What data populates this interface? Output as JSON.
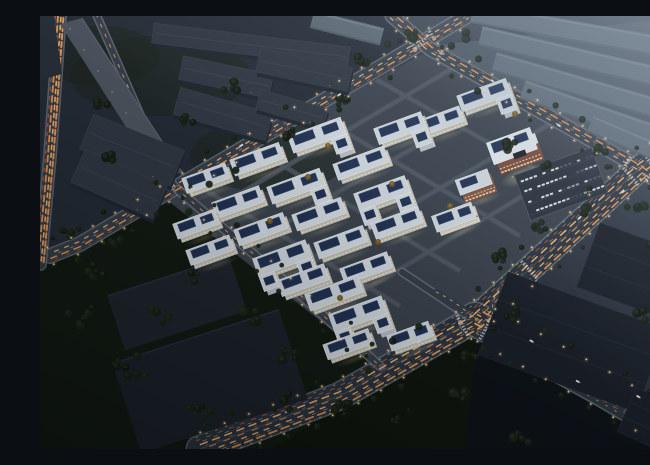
{
  "meta": {
    "description": "Aerial dusk rendering of an illuminated industrial park campus with grid streets, light-trail roads, solar rooftops and surrounding dark warehouses"
  },
  "palette": {
    "bg_top": "#3e4955",
    "bg_mid": "#2a323d",
    "bg_low": "#151b23",
    "hazy_ground": "#46515d",
    "tl_ground": "#242b35",
    "green_dark": "#121a13",
    "wedge_green": "#10160f",
    "below_se": "#0e1319",
    "right_tri": "#2a323c",
    "campus_ground": "#39414b",
    "street": "#49525c",
    "curb": "#6d7681",
    "road": "#343d48",
    "road_dark": "#2b333e",
    "median": "#515d69",
    "facade": "#b4bbc1",
    "roof": "#ccd4da",
    "roof_edge": "#e4e9ec",
    "solar": "#223150",
    "solar_line": "#3a5185",
    "warm1": "#ecd6a0",
    "warm2": "#d0bd8e",
    "hq_red": "#77493b",
    "hq_red_dark": "#5d382e",
    "hq_white": "#dde3e7",
    "tl_roof": "#2e3641",
    "tl_side": "#1f2630",
    "tl_ridge": "#3a4350",
    "hazy_fill": "#5d6975",
    "hazy_ridge": "#717d89",
    "bl_fill": "#1f252e",
    "bl_fill2": "#1c222b",
    "dr_fill": "#191f28",
    "slab_fill": "#49525c",
    "tree_a": "#121a11",
    "tree_b": "#161f15",
    "tree_c": "#1a241a",
    "tree_warm": "#6e5423",
    "tree_warm_core": "#8a6c30",
    "light_dot": "#ffd9a2",
    "fog": "#a6b4c2",
    "crosswalk": "#cfd6da",
    "car_body": "#dce2e6"
  },
  "scene": {
    "canvas": {
      "w": 650,
      "h": 433
    },
    "ground_polys": [
      {
        "name": "hazy-ground",
        "pts": [
          [
            390,
            30
          ],
          [
            650,
            0
          ],
          [
            650,
            118
          ],
          [
            600,
            152
          ]
        ],
        "fill": "hazy_ground"
      },
      {
        "name": "tl-ground",
        "pts": [
          [
            0,
            0
          ],
          [
            352,
            0
          ],
          [
            390,
            33
          ],
          [
            40,
            228
          ],
          [
            0,
            238
          ]
        ],
        "fill": "tl_ground"
      },
      {
        "name": "green-bottom-left",
        "pts": [
          [
            0,
            240
          ],
          [
            128,
            178
          ],
          [
            340,
            352
          ],
          [
            310,
            433
          ],
          [
            0,
            433
          ]
        ],
        "fill": "green_dark"
      },
      {
        "name": "right-triangle",
        "pts": [
          [
            600,
            152
          ],
          [
            650,
            118
          ],
          [
            650,
            180
          ]
        ],
        "fill": "right_tri"
      },
      {
        "name": "campus",
        "pts": [
          [
            393,
            33
          ],
          [
            604,
            152
          ],
          [
            438,
            302
          ],
          [
            340,
            352
          ],
          [
            122,
            180
          ]
        ],
        "fill": "campus_ground"
      },
      {
        "name": "wedge-below-fork",
        "pts": [
          [
            438,
            308
          ],
          [
            615,
            420
          ],
          [
            560,
            433
          ],
          [
            230,
            433
          ]
        ],
        "fill": "wedge_green"
      },
      {
        "name": "below-se-avenue",
        "pts": [
          [
            440,
            306
          ],
          [
            650,
            428
          ],
          [
            650,
            433
          ],
          [
            425,
            433
          ]
        ],
        "fill": "below_se"
      }
    ],
    "trail_styles": {
      "std": [
        {
          "off": -2.5,
          "c": "#e09050",
          "w": 1.6,
          "d": "7 6",
          "op": 0.95
        },
        {
          "off": 2.5,
          "c": "#f2b068",
          "w": 1.3,
          "d": "4 7",
          "op": 0.9
        },
        {
          "off": 0,
          "c": "#cdd5d9",
          "w": 0.8,
          "d": "3 10",
          "op": 0.5
        },
        {
          "off": -5,
          "c": "#b05a38",
          "w": 1.0,
          "d": "3 9",
          "op": 0.7
        }
      ],
      "ave": [
        {
          "off": -10,
          "c": "#e09050",
          "w": 1.8,
          "d": "8 5",
          "op": 0.95
        },
        {
          "off": -5,
          "c": "#f2b068",
          "w": 1.4,
          "d": "5 7",
          "op": 0.9
        },
        {
          "off": -1,
          "c": "#e09050",
          "w": 1.2,
          "d": "6 9",
          "op": 0.8
        },
        {
          "off": 4,
          "c": "#f2b068",
          "w": 1.6,
          "d": "7 6",
          "op": 0.95
        },
        {
          "off": 9,
          "c": "#b05a38",
          "w": 1.2,
          "d": "4 8",
          "op": 0.8
        },
        {
          "off": 6.5,
          "c": "#cdd5d9",
          "w": 0.7,
          "d": "4 8",
          "op": 0.55
        },
        {
          "off": -7.5,
          "c": "#cdd5d9",
          "w": 0.7,
          "d": "4 8",
          "op": 0.55
        },
        {
          "off": 1.5,
          "c": "#cdd5d9",
          "w": 0.6,
          "d": "3 10",
          "op": 0.4
        },
        {
          "off": 12,
          "c": "#8fb878",
          "w": 1.0,
          "d": "1.5 9",
          "op": 0.8
        },
        {
          "off": -13,
          "c": "#8fb878",
          "w": 1.0,
          "d": "1.5 9",
          "op": 0.8
        }
      ],
      "heavy": [
        {
          "off": -3.5,
          "c": "#e09050",
          "w": 2.0,
          "d": "5 3",
          "op": 1
        },
        {
          "off": -1,
          "c": "#f2b068",
          "w": 1.6,
          "d": "4 4",
          "op": 0.95
        },
        {
          "off": 2,
          "c": "#e09050",
          "w": 1.8,
          "d": "6 4",
          "op": 1
        },
        {
          "off": 4.5,
          "c": "#b05a38",
          "w": 1.4,
          "d": "3 6",
          "op": 0.8
        }
      ],
      "thin": [
        {
          "off": 0,
          "c": "#f2b068",
          "w": 1.0,
          "d": "3 8",
          "op": 0.8
        }
      ],
      "none": []
    },
    "roads": [
      {
        "name": "nw-boundary",
        "pts": [
          [
            427,
            0
          ],
          [
            40,
            228
          ],
          [
            10,
            240
          ]
        ],
        "w": 13,
        "style": "std",
        "lights": true,
        "trees": true,
        "dark": false
      },
      {
        "name": "ne-boundary",
        "pts": [
          [
            352,
            0
          ],
          [
            390,
            33
          ],
          [
            600,
            152
          ],
          [
            650,
            192
          ]
        ],
        "w": 12,
        "style": "std",
        "lights": true,
        "trees": true,
        "dark": false
      },
      {
        "name": "avenue-upper",
        "pts": [
          [
            650,
            116
          ],
          [
            600,
            152
          ],
          [
            435,
            303
          ]
        ],
        "w": 24,
        "style": "ave",
        "lights": true,
        "trees": true,
        "dark": true
      },
      {
        "name": "avenue-sw",
        "pts": [
          [
            435,
            303
          ],
          [
            300,
            380
          ],
          [
            160,
            433
          ]
        ],
        "w": 26,
        "style": "ave",
        "lights": true,
        "trees": true,
        "dark": true
      },
      {
        "name": "avenue-se",
        "pts": [
          [
            435,
            303
          ],
          [
            560,
            372
          ],
          [
            650,
            425
          ]
        ],
        "w": 32,
        "style": "ave",
        "lights": true,
        "trees": true,
        "dark": true
      },
      {
        "name": "west-elevated",
        "pts": [
          [
            20,
            0
          ],
          [
            10,
            140
          ],
          [
            0,
            248
          ]
        ],
        "w": 11,
        "style": "heavy",
        "lights": false,
        "trees": false,
        "dark": false
      },
      {
        "name": "slab-side",
        "pts": [
          [
            57,
            0
          ],
          [
            128,
            162
          ],
          [
            138,
            174
          ]
        ],
        "w": 6,
        "style": "thin",
        "lights": false,
        "trees": false,
        "dark": false
      },
      {
        "name": "campus-sw-street",
        "pts": [
          [
            138,
            174
          ],
          [
            230,
            252
          ],
          [
            340,
            350
          ]
        ],
        "w": 7,
        "style": "thin",
        "lights": true,
        "trees": true,
        "dark": false
      },
      {
        "name": "campus-entry",
        "pts": [
          [
            362,
            256
          ],
          [
            428,
            300
          ]
        ],
        "w": 6,
        "style": "none",
        "lights": false,
        "trees": false,
        "dark": false
      }
    ],
    "slip_arcs": [
      {
        "d": "M 396,276 Q 420,287 444,312",
        "w": 6
      },
      {
        "d": "M 470,262 Q 437,291 466,320",
        "w": 7
      }
    ],
    "internal_streets": [
      [
        330,
        60,
        570,
        195
      ],
      [
        270,
        95,
        480,
        220
      ],
      [
        210,
        130,
        420,
        255
      ],
      [
        150,
        165,
        360,
        290
      ],
      [
        420,
        48,
        165,
        198
      ],
      [
        470,
        75,
        215,
        225
      ],
      [
        520,
        102,
        262,
        253
      ],
      [
        570,
        128,
        318,
        278
      ]
    ],
    "crosswalks": [
      {
        "road": "nw-boundary",
        "t": 40
      },
      {
        "road": "nw-boundary",
        "t": 62
      },
      {
        "road": "ne-boundary",
        "t": 40
      },
      {
        "road": "ne-boundary",
        "t": 62
      },
      {
        "road": "ne-boundary",
        "t": 278
      },
      {
        "road": "ne-boundary",
        "t": 304
      },
      {
        "road": "avenue-upper",
        "t": 50
      },
      {
        "road": "avenue-upper",
        "t": 74
      },
      {
        "road": "avenue-upper",
        "t": 212
      },
      {
        "road": "avenue-sw",
        "t": 14
      },
      {
        "road": "avenue-se",
        "t": 14
      }
    ],
    "campus_bars": [
      [
        448,
        83,
        52,
        17,
        1
      ],
      [
        404,
        109,
        46,
        16,
        0
      ],
      [
        364,
        116,
        50,
        17,
        1
      ],
      [
        281,
        123,
        56,
        18,
        1
      ],
      [
        221,
        147,
        52,
        17,
        0
      ],
      [
        170,
        166,
        46,
        16,
        0
      ],
      [
        325,
        151,
        54,
        17,
        0
      ],
      [
        260,
        174,
        56,
        18,
        1
      ],
      [
        202,
        190,
        50,
        17,
        0
      ],
      [
        160,
        212,
        44,
        16,
        0
      ],
      [
        346,
        181,
        54,
        18,
        2
      ],
      [
        283,
        202,
        52,
        17,
        0
      ],
      [
        225,
        217,
        52,
        17,
        0
      ],
      [
        174,
        238,
        46,
        16,
        0
      ],
      [
        361,
        211,
        50,
        17,
        0
      ],
      [
        305,
        230,
        52,
        17,
        0
      ],
      [
        246,
        246,
        56,
        19,
        2
      ],
      [
        330,
        256,
        50,
        17,
        0
      ],
      [
        267,
        268,
        50,
        17,
        0
      ],
      [
        298,
        281,
        56,
        18,
        0
      ],
      [
        322,
        302,
        56,
        19,
        2
      ],
      [
        312,
        332,
        48,
        16,
        0
      ],
      [
        374,
        324,
        44,
        16,
        0
      ],
      [
        418,
        205,
        42,
        17,
        3
      ]
    ],
    "bar_rot": -20,
    "red_building": {
      "x": 438,
      "y": 172,
      "len": 34,
      "wid": 20
    },
    "hq": {
      "x": 478,
      "y": 138,
      "len": 46,
      "wid": 28
    },
    "plaza": {
      "x": 466,
      "y": 163,
      "rx": 22,
      "ry": 9
    },
    "parking": {
      "x": 521,
      "y": 168,
      "w": 82,
      "h": 48,
      "rot": -20,
      "car_colors": [
        "#d8dde0",
        "#8f98a2",
        "#39424e",
        "#b0b8bf",
        "#4a545f"
      ]
    },
    "tl_warehouses": [
      [
        211,
        29,
        198,
        20,
        7
      ],
      [
        186,
        61,
        92,
        24,
        12
      ],
      [
        264,
        54,
        94,
        24,
        12
      ],
      [
        183,
        98,
        96,
        28,
        16
      ],
      [
        252,
        93,
        70,
        20,
        16
      ],
      [
        92,
        134,
        98,
        38,
        22
      ],
      [
        79,
        168,
        90,
        36,
        24
      ]
    ],
    "hazy_warehouses": [
      [
        540,
        16,
        220,
        20,
        10
      ],
      [
        550,
        45,
        225,
        20,
        13
      ],
      [
        560,
        76,
        220,
        20,
        16
      ],
      [
        575,
        105,
        195,
        20,
        19
      ],
      [
        610,
        133,
        130,
        18,
        23
      ],
      [
        307,
        12,
        72,
        18,
        14
      ]
    ],
    "bl_slabs": [
      [
        137,
        287,
        128,
        58,
        -18
      ],
      [
        170,
        365,
        175,
        95,
        -18
      ]
    ],
    "dr_slabs": [
      [
        604,
        259,
        118,
        68,
        20
      ],
      [
        532,
        326,
        168,
        88,
        20
      ],
      [
        628,
        412,
        90,
        48,
        24
      ]
    ],
    "slab_building": [
      [
        20,
        8
      ],
      [
        42,
        2
      ],
      [
        142,
        156
      ],
      [
        120,
        164
      ]
    ],
    "corner_block": [
      [
        0,
        0
      ],
      [
        14,
        0
      ],
      [
        22,
        58
      ],
      [
        0,
        64
      ]
    ],
    "tree_clusters": [
      [
        40,
        300,
        7,
        26
      ],
      [
        90,
        350,
        8,
        30
      ],
      [
        160,
        395,
        7,
        26
      ],
      [
        55,
        255,
        5,
        18
      ],
      [
        210,
        300,
        5,
        20
      ],
      [
        250,
        340,
        5,
        18
      ],
      [
        300,
        395,
        6,
        22
      ],
      [
        240,
        390,
        5,
        20
      ],
      [
        120,
        300,
        5,
        20
      ],
      [
        28,
        218,
        4,
        14
      ],
      [
        75,
        225,
        4,
        14
      ],
      [
        150,
        260,
        4,
        16
      ],
      [
        190,
        70,
        5,
        18
      ],
      [
        250,
        115,
        5,
        16
      ],
      [
        300,
        85,
        4,
        14
      ],
      [
        150,
        105,
        4,
        14
      ],
      [
        320,
        45,
        4,
        12
      ],
      [
        370,
        20,
        4,
        12
      ],
      [
        60,
        90,
        4,
        16
      ],
      [
        70,
        140,
        4,
        14
      ],
      [
        460,
        240,
        5,
        16
      ],
      [
        495,
        210,
        4,
        14
      ],
      [
        545,
        195,
        4,
        12
      ],
      [
        470,
        130,
        5,
        14
      ],
      [
        505,
        150,
        4,
        12
      ],
      [
        560,
        135,
        4,
        12
      ],
      [
        600,
        190,
        4,
        12
      ],
      [
        615,
        230,
        4,
        14
      ],
      [
        470,
        300,
        4,
        14
      ],
      [
        430,
        340,
        4,
        12
      ],
      [
        600,
        300,
        4,
        14
      ],
      [
        640,
        330,
        4,
        14
      ],
      [
        420,
        380,
        5,
        18
      ],
      [
        480,
        420,
        5,
        18
      ],
      [
        360,
        400,
        5,
        20
      ],
      [
        640,
        60,
        3,
        10
      ],
      [
        430,
        20,
        3,
        10
      ]
    ],
    "warm_trees": [
      [
        268,
        161
      ],
      [
        338,
        226
      ],
      [
        300,
        282
      ],
      [
        410,
        190
      ],
      [
        352,
        168
      ],
      [
        230,
        205
      ],
      [
        288,
        130
      ],
      [
        475,
        98
      ]
    ],
    "cars": [
      {
        "road": "avenue-se",
        "t": 60,
        "o": -8
      },
      {
        "road": "avenue-se",
        "t": 120,
        "o": 5
      },
      {
        "road": "avenue-se",
        "t": 180,
        "o": -12
      },
      {
        "road": "avenue-sw",
        "t": 60,
        "o": 8
      },
      {
        "road": "avenue-upper",
        "t": 90,
        "o": -6
      },
      {
        "road": "avenue-upper",
        "t": 140,
        "o": 4
      },
      {
        "road": "ne-boundary",
        "t": 120,
        "o": -3
      },
      {
        "road": "ne-boundary",
        "t": 200,
        "o": 3
      },
      {
        "road": "nw-boundary",
        "t": 150,
        "o": -3
      },
      {
        "road": "nw-boundary",
        "t": 260,
        "o": 3
      }
    ]
  }
}
